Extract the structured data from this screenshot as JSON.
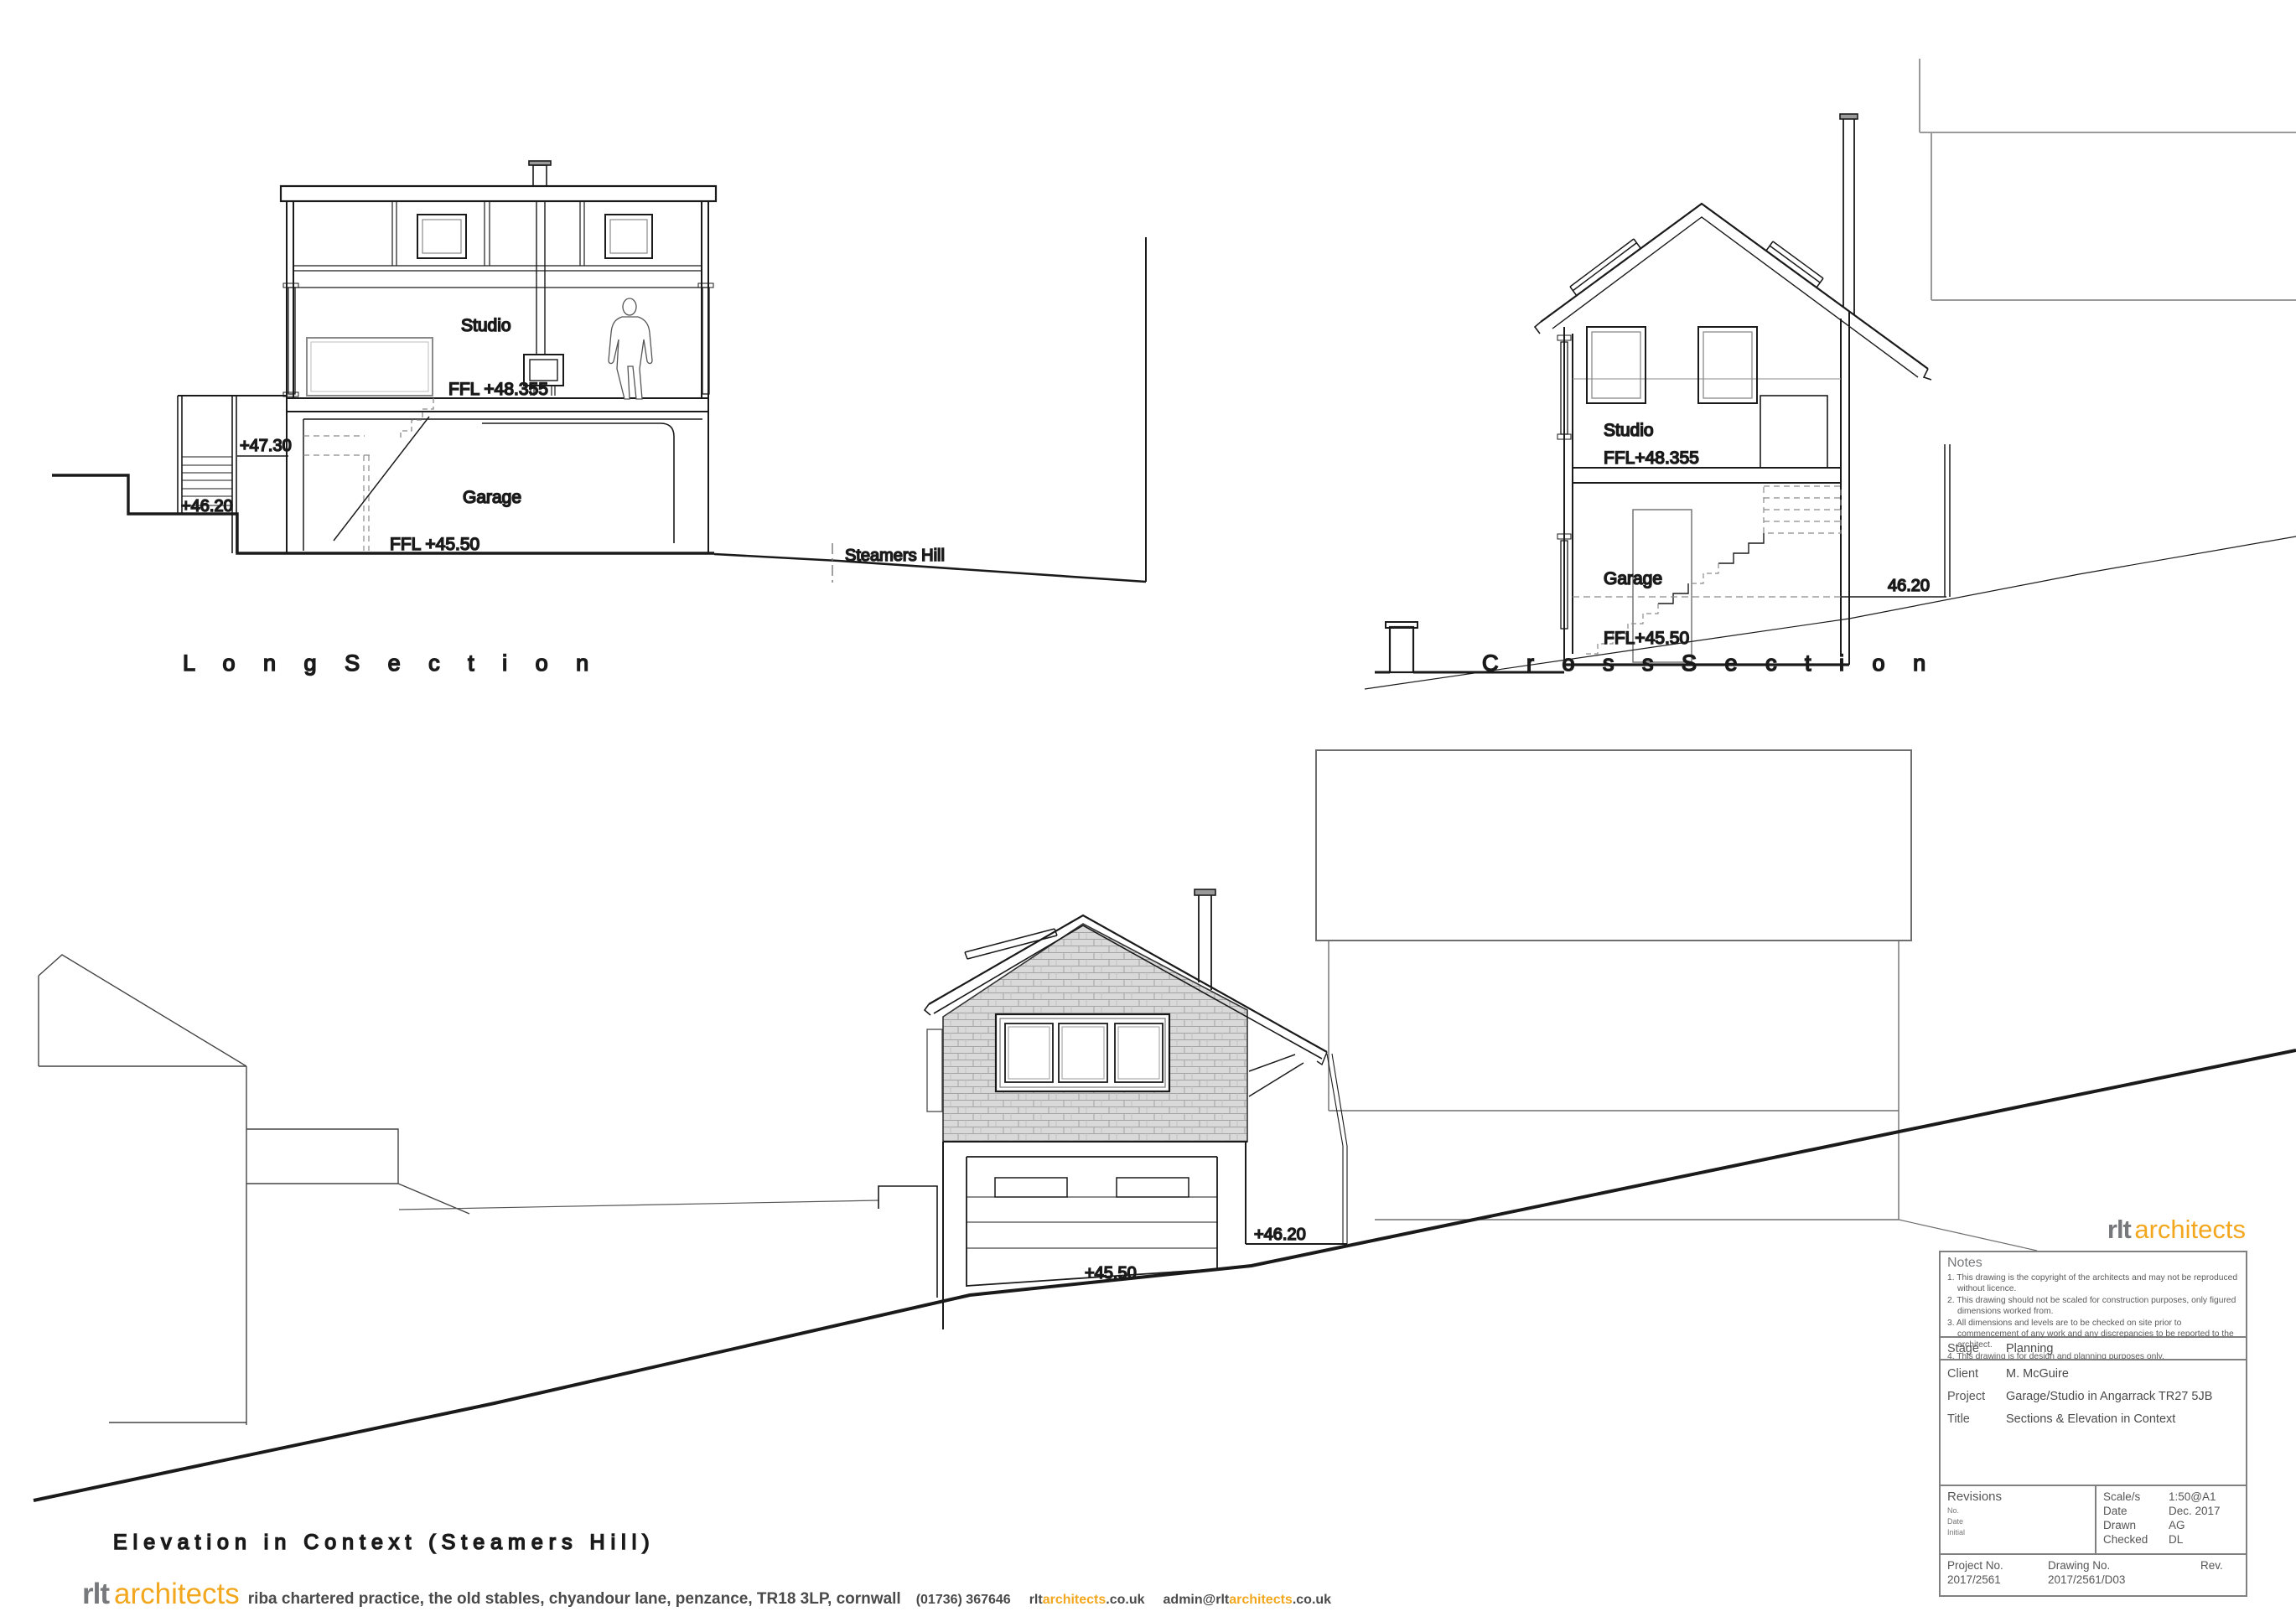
{
  "colors": {
    "accent_orange": "#F2A71E",
    "logo_grey": "#77787B",
    "line_dark": "#1a1a1a",
    "line_grey": "#999999",
    "border_grey": "#808080",
    "shingle_fill": "#d9d9d9"
  },
  "drawings": {
    "long_section": {
      "title": "L o n g   S e c t i o n",
      "room_upper": "Studio",
      "ffl_upper": "FFL +48.355",
      "room_lower": "Garage",
      "ffl_lower": "FFL +45.50",
      "level_landing": "+47.30",
      "level_path": "+46.20",
      "road_label": "Steamers Hill"
    },
    "cross_section": {
      "title": "C r o s s   S e c t i o n",
      "room_upper": "Studio",
      "ffl_upper": "FFL+48.355",
      "room_lower": "Garage",
      "ffl_lower": "FFL+45.50",
      "level_right": "46.20"
    },
    "elevation": {
      "title": "Elevation in  Context (Steamers Hill)",
      "level_wall": "+46.20",
      "level_road": "+45.50"
    }
  },
  "title_block": {
    "logo": {
      "rlt": "rlt",
      "architects": "architects"
    },
    "notes": {
      "heading": "Notes",
      "items": [
        "1. This drawing is the copyright of the architects and may not be reproduced without licence.",
        "2. This drawing should not be scaled for construction purposes, only figured dimensions worked from.",
        "3. All dimensions and levels are to be checked on site prior to commencement of any work and any discrepancies to be reported to the architect.",
        "4. This drawing is for design and planning purposes only."
      ]
    },
    "fields": {
      "stage_label": "Stage",
      "stage_value": "Planning",
      "client_label": "Client",
      "client_value": "M. McGuire",
      "project_label": "Project",
      "project_value": "Garage/Studio in Angarrack TR27 5JB",
      "title_label": "Title",
      "title_value": "Sections & Elevation in Context"
    },
    "revisions": {
      "heading": "Revisions",
      "sub1": "No.",
      "sub2": "Date",
      "sub3": "Initial"
    },
    "meta": {
      "scale_label": "Scale/s",
      "scale_value": "1:50@A1",
      "date_label": "Date",
      "date_value": "Dec. 2017",
      "drawn_label": "Drawn",
      "drawn_value": "AG",
      "checked_label": "Checked",
      "checked_value": "DL"
    },
    "numbers": {
      "project_label": "Project No.",
      "project_value": "2017/2561",
      "drawing_label": "Drawing No.",
      "drawing_value": "2017/2561/D03",
      "rev_label": "Rev."
    }
  },
  "footer": {
    "logo_rlt": "rlt",
    "logo_architects": "architects",
    "practice": "riba chartered practice",
    "address": ",  the old stables,  chyandour lane,  penzance,  TR18 3LP,  cornwall",
    "phone": "(01736) 367646",
    "web_prefix": "rlt",
    "web_mid": "architects",
    "web_suffix": ".co.uk",
    "email_prefix": "admin@rlt",
    "email_mid": "architects",
    "email_suffix": ".co.uk"
  }
}
